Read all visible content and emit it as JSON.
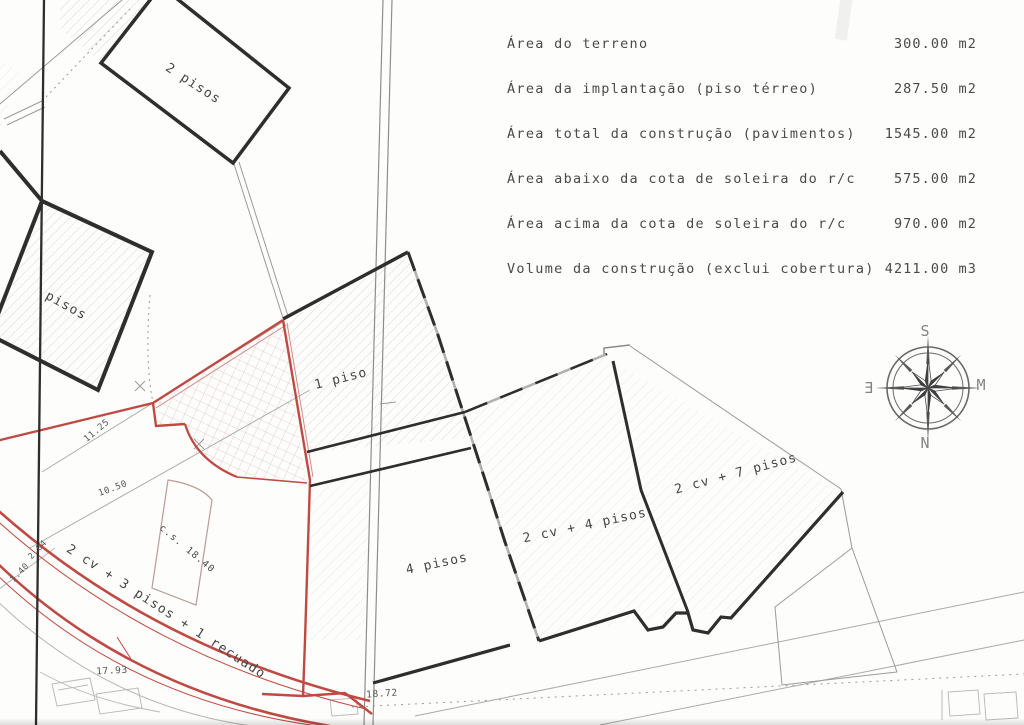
{
  "table": {
    "rows": [
      {
        "label": "Área do terreno",
        "value": "300.00 m2"
      },
      {
        "label": "Área da implantação (piso térreo)",
        "value": "287.50 m2"
      },
      {
        "label": "Área total da construção (pavimentos)",
        "value": "1545.00 m2"
      },
      {
        "label": "Área abaixo da cota de soleira do r/c",
        "value": "575.00 m2"
      },
      {
        "label": "Área acima da cota de soleira do r/c",
        "value": "970.00 m2"
      },
      {
        "label": "Volume da construção (exclui cobertura)",
        "value": "4211.00 m3"
      }
    ]
  },
  "plan": {
    "labels": [
      {
        "text": "2 pisos"
      },
      {
        "text": "pisos"
      },
      {
        "text": "1 piso"
      },
      {
        "text": "4 pisos"
      },
      {
        "text": "2 cv + 4 pisos"
      },
      {
        "text": "2 cv + 7 pisos"
      },
      {
        "text": "2 cv + 3 pisos + 1 recuado"
      },
      {
        "text": "c.s. 18.40"
      }
    ],
    "measurements": [
      {
        "text": "11.25"
      },
      {
        "text": "10.50"
      },
      {
        "text": "1.40"
      },
      {
        "text": "2.04"
      },
      {
        "text": "17.93"
      },
      {
        "text": "18.72"
      }
    ]
  },
  "compass": {
    "top": "S",
    "right": "M",
    "bottom": "N",
    "left": "E"
  },
  "colors": {
    "red_boundary": "#bf4a44",
    "line_dark": "#2e2e2e"
  }
}
